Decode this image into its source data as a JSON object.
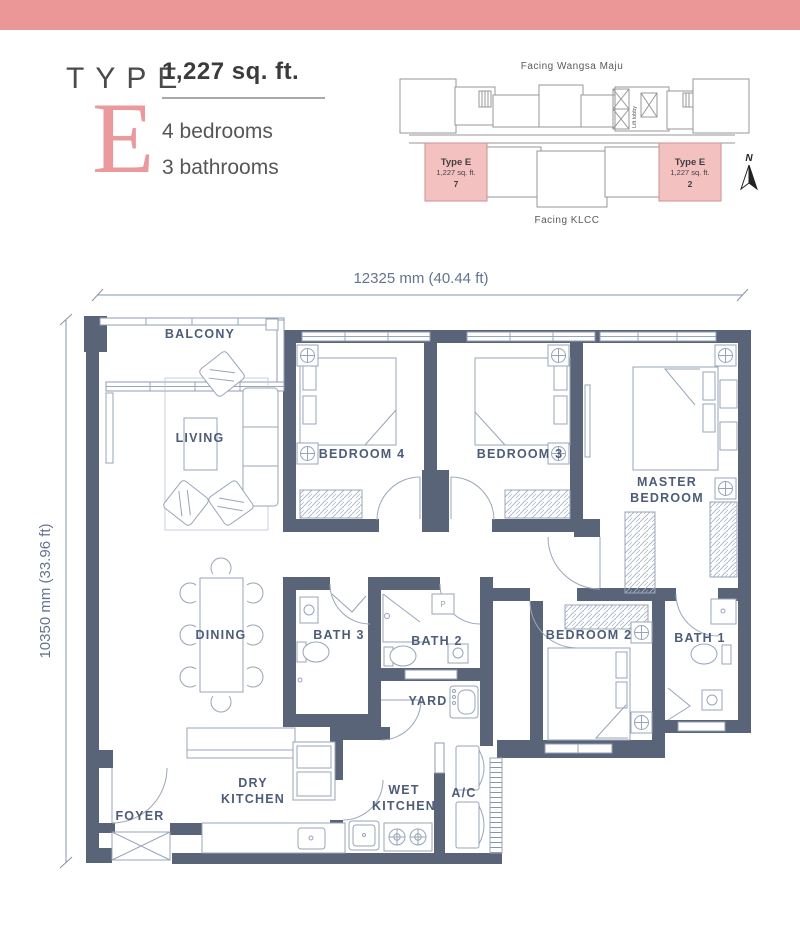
{
  "header": {
    "type_label": "TYPE",
    "type_letter": "E",
    "area": "1,227 sq. ft.",
    "bedrooms": "4 bedrooms",
    "bathrooms": "3 bathrooms"
  },
  "key_plan": {
    "facing_top": "Facing Wangsa Maju",
    "facing_bottom": "Facing KLCC",
    "lift_lobby": "Lift lobby",
    "north": "N",
    "unit_left": {
      "name": "Type E",
      "area": "1,227 sq. ft.",
      "number": "7"
    },
    "unit_right": {
      "name": "Type E",
      "area": "1,227 sq. ft.",
      "number": "2"
    }
  },
  "dimensions": {
    "width": "12325 mm (40.44 ft)",
    "height": "10350 mm (33.96 ft)"
  },
  "rooms": {
    "balcony": "BALCONY",
    "living": "LIVING",
    "bedroom4": "BEDROOM 4",
    "bedroom3": "BEDROOM 3",
    "master_line1": "MASTER",
    "master_line2": "BEDROOM",
    "dining": "DINING",
    "bath3": "BATH 3",
    "bath2": "BATH 2",
    "bedroom2": "BEDROOM 2",
    "bath1": "BATH 1",
    "yard": "YARD",
    "dry_line1": "DRY",
    "dry_line2": "KITCHEN",
    "wet_line1": "WET",
    "wet_line2": "KITCHEN",
    "ac": "A/C",
    "foyer": "FOYER"
  },
  "fixtures": {
    "heater_label": "P"
  },
  "colors": {
    "accent_pink": "#EB9697",
    "wall": "#5A6479",
    "label": "#4D5C78",
    "keyplan_unit_pink": "#F4C1C1"
  }
}
